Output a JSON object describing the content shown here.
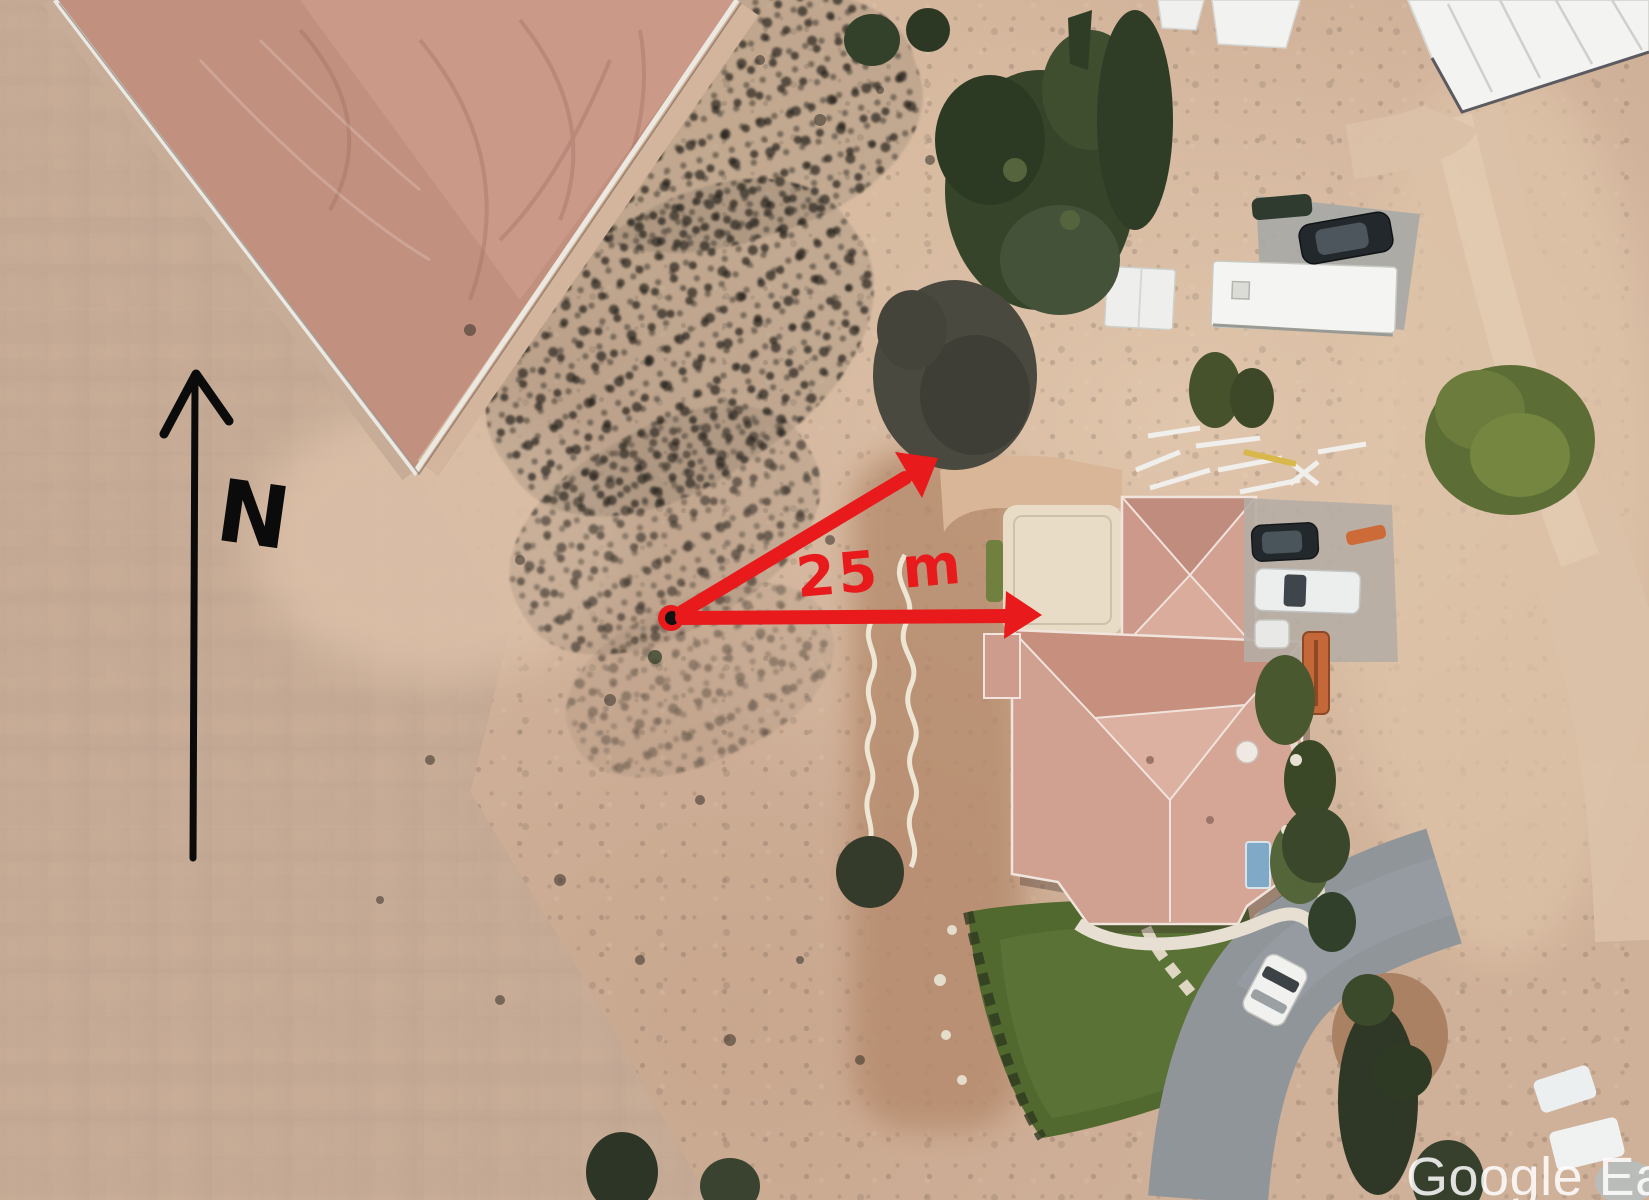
{
  "canvas": {
    "width_px": 1649,
    "height_px": 1200
  },
  "image_type": "annotated aerial satellite view",
  "annotations": {
    "north_arrow": {
      "label": "N"
    },
    "measurement": {
      "label": "25 m"
    },
    "watermark": {
      "text": "Google Ea"
    }
  },
  "palette": {
    "annotation-red": "#e81a1c",
    "ink-black": "#0b0b0b",
    "watermark-white": "rgba(255,255,255,0.85)",
    "sand": "#cfb098",
    "sand-light": "#e0c6ac",
    "scrub-gray": "#8d8078",
    "field-pink": "#c2907f",
    "fence-white": "#ece9e2",
    "roof-terracotta": "#cd9c8d",
    "roof-ridge": "#f1e4dc",
    "lawn-green": "#51682f",
    "tree-dark": "#36452a",
    "tree-leafy": "#5c6d35",
    "asphalt": "#90959a",
    "concrete": "#a6a8a6",
    "building-white": "#f3f3f1",
    "pool-blue": "#7fa9c6",
    "yard-brown": "#b58a6c",
    "court-tan": "#e8dcc6"
  }
}
